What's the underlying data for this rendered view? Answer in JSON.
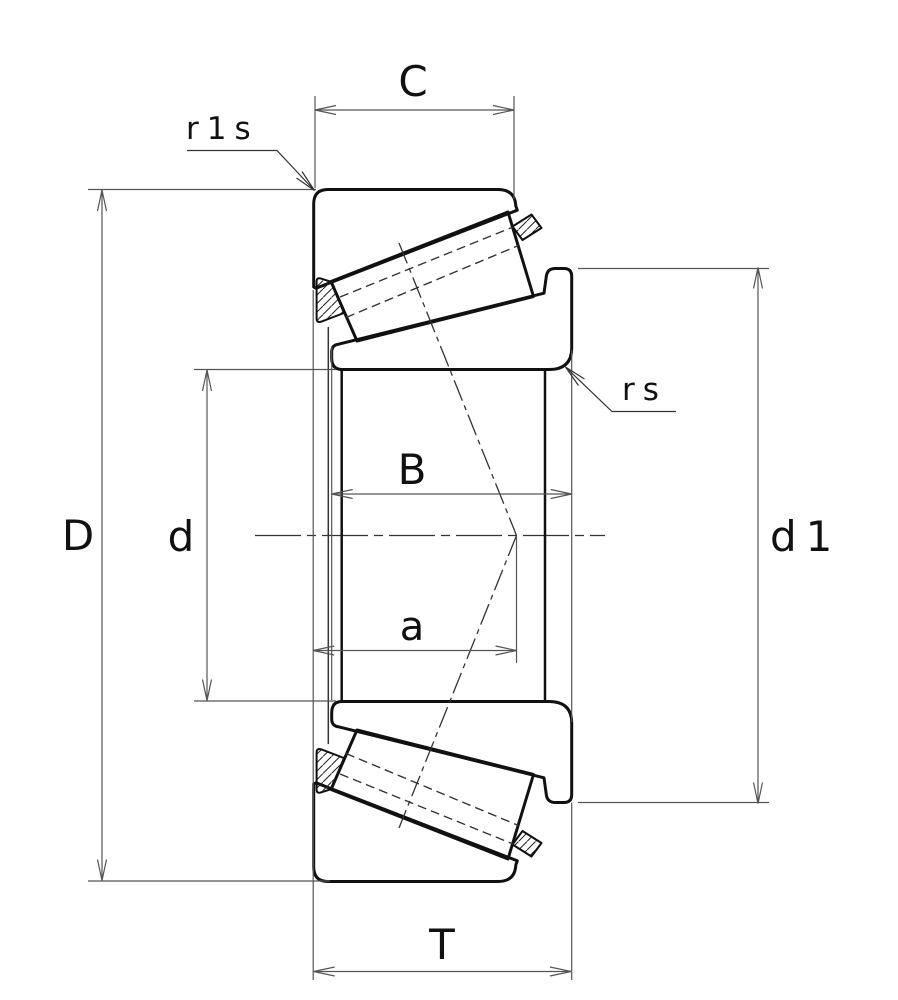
{
  "drawing": {
    "title": "Tapered roller bearing dimensional cross-section",
    "kind": "engineering-diagram"
  },
  "colors": {
    "background": "#ffffff",
    "contour_line": "#111111",
    "thin_line": "#555555",
    "center_line": "#333333",
    "text": "#111111"
  },
  "labels": {
    "C": "C",
    "r1s": "r1s",
    "rs": "rs",
    "B": "B",
    "a": "a",
    "d": "d",
    "D": "D",
    "d1": "d1",
    "T": "T"
  }
}
